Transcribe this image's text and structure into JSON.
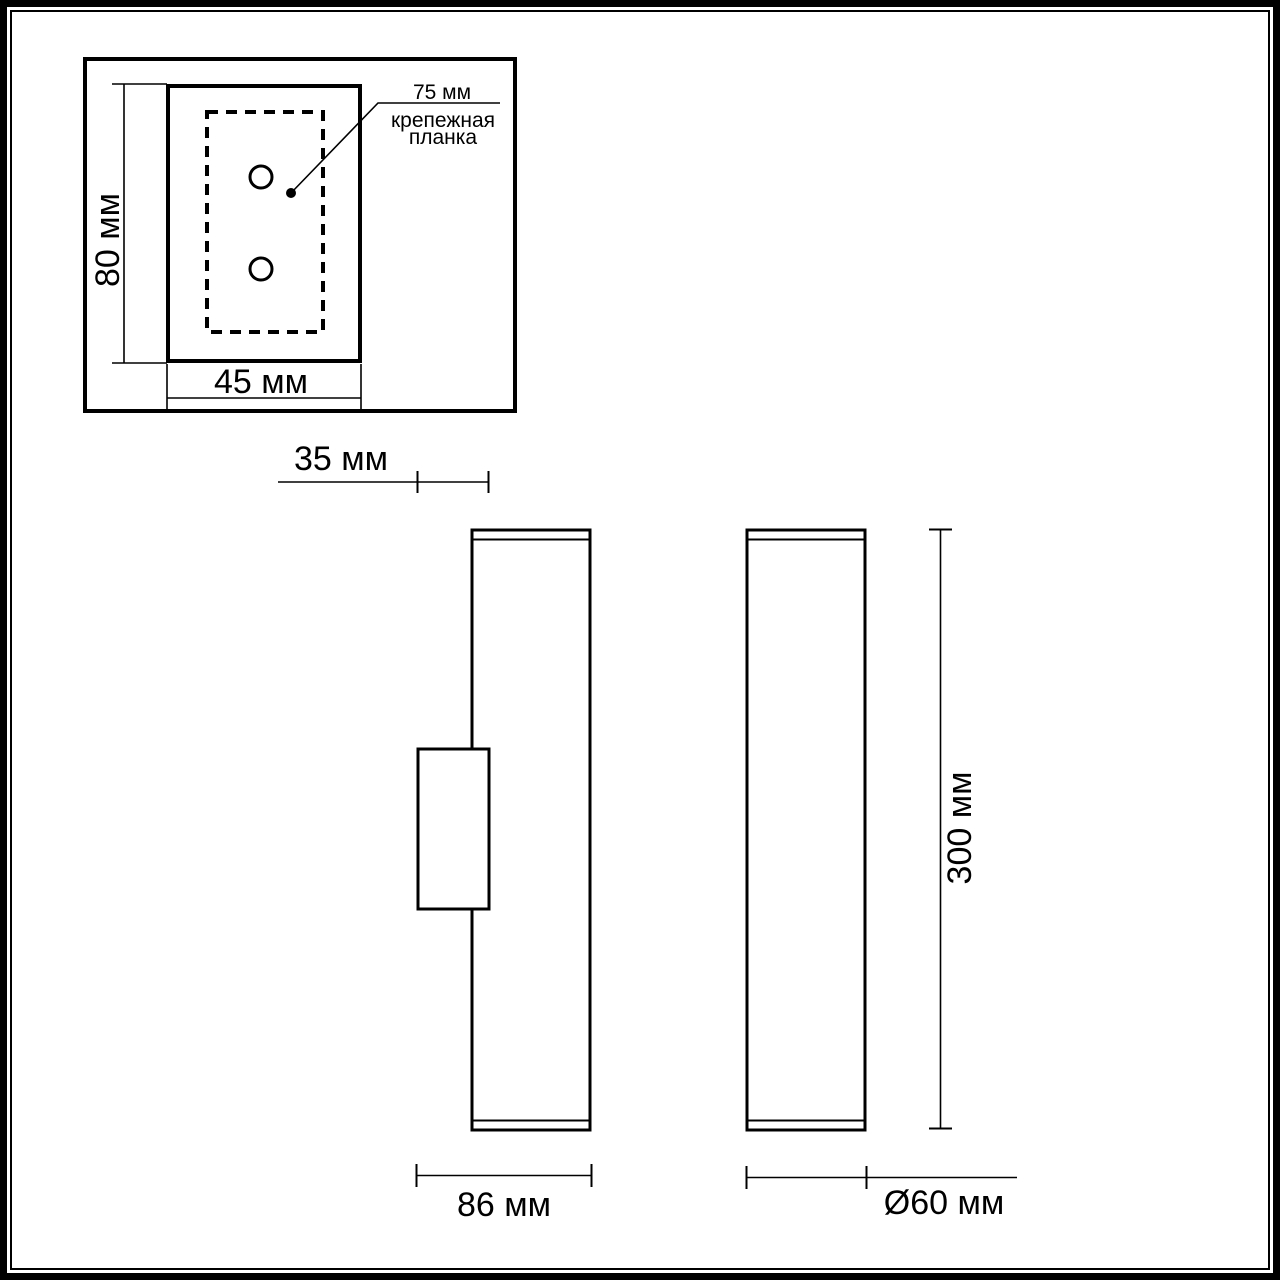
{
  "colors": {
    "line": "#000000",
    "background": "#ffffff"
  },
  "detail_view": {
    "height_label": "80 мм",
    "width_label": "45 мм",
    "plate_length_label": "75 мм",
    "plate_caption_line1": "крепежная",
    "plate_caption_line2": "планка",
    "mounting_holes": 2
  },
  "offset": {
    "label": "35 мм"
  },
  "side_view": {
    "depth_label": "86 мм"
  },
  "front_view": {
    "height_label": "300 мм",
    "diameter_label": "Ø60 мм"
  }
}
